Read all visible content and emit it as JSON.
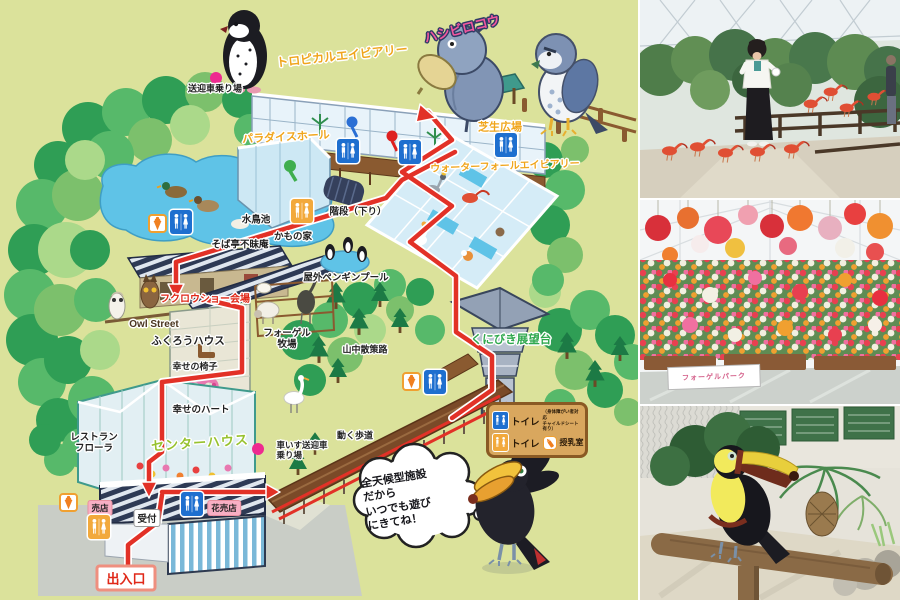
{
  "colors": {
    "map_bg": "#dbe29b",
    "route_red": "#e23127",
    "pond_blue": "#5fc3e7",
    "toilet_blue": "#1e6fcf",
    "toilet_orange": "#f2a93c",
    "stop_dot_pink": "#ee2a90",
    "label_yellow": "#f0a51c",
    "label_pink": "#f2579f",
    "label_green": "#2fa84e"
  },
  "icons": {
    "toilet": "restroom-figures",
    "soft_cream": "soft-serve-cone",
    "nursing_bottle": "baby-bottle",
    "shuttle_stop": "pink-dot"
  },
  "map": {
    "labels": {
      "shuttle_stop": "送迎車乗り場",
      "tropical_aviary": "トロピカルエイビアリー",
      "shoebill": "ハシビロコウ",
      "lawn_plaza": "芝生広場",
      "paradise_hall": "パラダイスホール",
      "waterfall_aviary": "ウォーターフォールエイビアリー",
      "pond": "水鳥池",
      "stairs_down": "階段（下り）",
      "soba": "そば亭不昧庵",
      "duck_house": "かもの家",
      "penguin_pool": "屋外ペンギンプール",
      "owl_show": "フクロウショー会場",
      "owl_street": "Owl Street",
      "owl_house": "ふくろうハウス",
      "happy_chair": "幸せの椅子",
      "happy_heart": "幸せのハート",
      "ranch": "フォーゲル\n牧場",
      "trail": "山中散策路",
      "observatory": "くにびき展望台",
      "restaurant": "レストラン\nフローラ",
      "center_house": "センターハウス",
      "wheelchair_stop": "車いす送迎車\n乗り場",
      "walkway": "動く歩道",
      "shop": "売店",
      "reception": "受付",
      "flower_shop": "花売店",
      "entrance": "出入口"
    },
    "legend": {
      "toilet_accessible": "トイレ",
      "toilet_note": "（身体障がい者対応\nチャイルドシート有り）",
      "toilet": "トイレ",
      "nursing": "授乳室"
    },
    "bubble": "全天候型施設\nだから\nいつでも遊び\nにきてね！"
  },
  "photos": {
    "flower_sign": "フォーゲルパーク"
  }
}
